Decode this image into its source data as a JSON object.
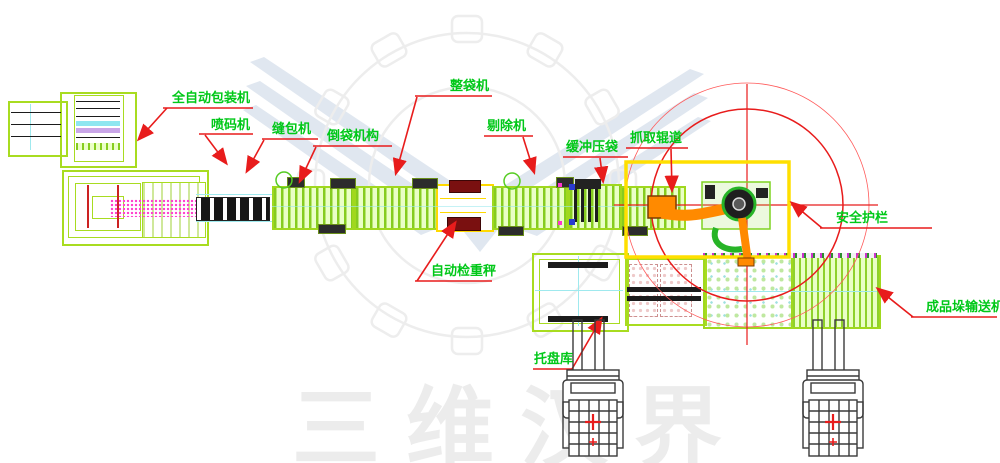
{
  "diagram": {
    "watermark_text": "三维汉界",
    "labels": {
      "auto_packer": "全自动包装机",
      "inkjet_coder": "喷码机",
      "bag_sewing": "缝包机",
      "bag_inverting": "倒袋机构",
      "bag_shaping": "整袋机",
      "rejecting": "剔除机",
      "buffer_pressing": "缓冲压袋",
      "pickup_conveyor": "抓取辊道",
      "safety_fence": "安全护栏",
      "checkweigher": "自动检重秤",
      "pallet_magazine": "托盘库",
      "finished_stack_conveyor": "成品垛输送机"
    },
    "colors": {
      "label_green": "#00c818",
      "leader_red": "#e81c1c",
      "machine_green": "#a8dc20",
      "conveyor_fill": "#eaffc6",
      "fence_yellow": "#ffdf00",
      "checkweigher_yellow": "#ffd900",
      "robot_orange": "#ff8a00",
      "robot_green": "#27b427",
      "dark_red": "#7a1010",
      "magenta": "#ff35cc",
      "cyan": "#9fe9ee",
      "watermark_gray": "#ececec"
    }
  }
}
